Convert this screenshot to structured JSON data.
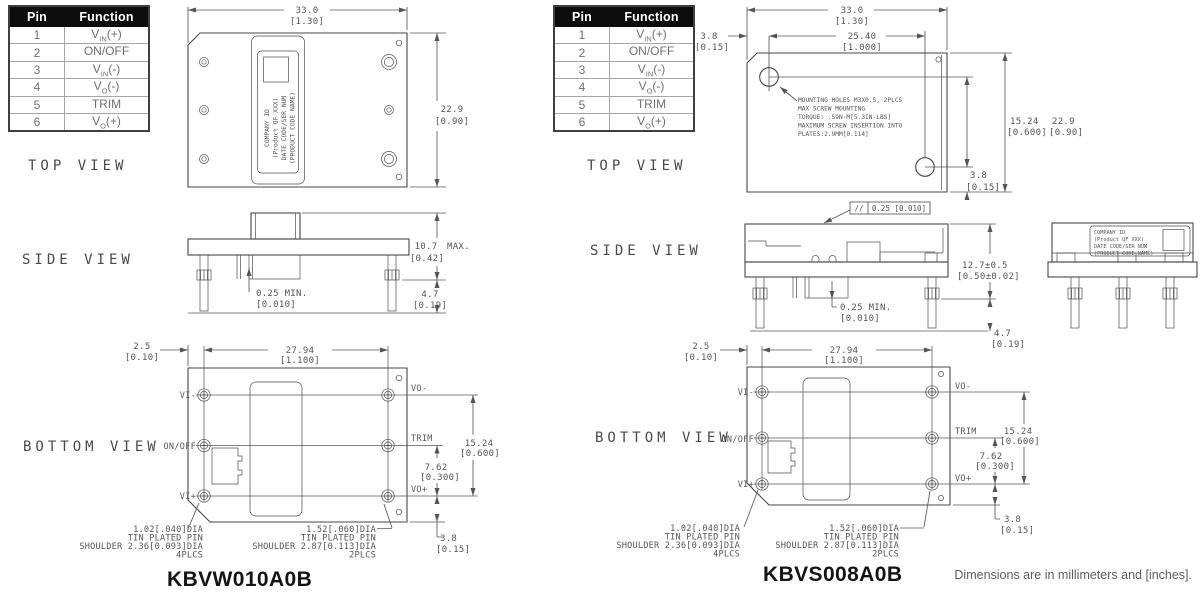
{
  "footer": "Dimensions are in millimeters and [inches].",
  "views": {
    "top": "TOP VIEW",
    "side": "SIDE VIEW",
    "bottom": "BOTTOM VIEW"
  },
  "pin_table": {
    "headers": [
      "Pin",
      "Function"
    ],
    "rows": [
      {
        "pin": "1",
        "pre": "V",
        "sub": "IN",
        "post": "(+)"
      },
      {
        "pin": "2",
        "pre": "ON/OFF",
        "sub": "",
        "post": ""
      },
      {
        "pin": "3",
        "pre": "V",
        "sub": "IN",
        "post": "(-)"
      },
      {
        "pin": "4",
        "pre": "V",
        "sub": "O",
        "post": "(-)"
      },
      {
        "pin": "5",
        "pre": "TRIM",
        "sub": "",
        "post": ""
      },
      {
        "pin": "6",
        "pre": "V",
        "sub": "O",
        "post": "(+)"
      }
    ]
  },
  "module_label": {
    "l1": "COMPANY ID",
    "l2": "(Product QF XXX)",
    "l3": "DATE CODE/SER NUM",
    "l4": "(PRODUCT CODE NAME)"
  },
  "left": {
    "title": "KBVW010A0B",
    "top": {
      "w": "33.0",
      "wb": "[1.30]",
      "h": "22.9",
      "hb": "[0.90]"
    },
    "side": {
      "h": "10.7",
      "max": "MAX.",
      "hb": "[0.42]",
      "min": "0.25 MIN.",
      "minb": "[0.010]",
      "pin": "4.7",
      "pinb": "[0.19]"
    },
    "bottom": {
      "edge": "2.5",
      "edgeb": "[0.10]",
      "pitch": "27.94",
      "pitchb": "[1.100]",
      "v1": "15.24",
      "v1b": "[0.600]",
      "v2": "7.62",
      "v2b": "[0.300]",
      "v3": "3.8",
      "v3b": "[0.15]",
      "vi_m": "VI-",
      "onoff": "ON/OFF",
      "vi_p": "VI+",
      "vo_m": "VO-",
      "trim": "TRIM",
      "vo_p": "VO+"
    },
    "note_a": [
      "1.02[.040]DIA",
      "TIN PLATED PIN",
      "SHOULDER 2.36[0.093]DIA",
      "4PLCS"
    ],
    "note_b": [
      "1.52[.060]DIA",
      "TIN PLATED PIN",
      "SHOULDER 2.87[0.113]DIA",
      "2PLCS"
    ]
  },
  "right": {
    "title": "KBVS008A0B",
    "top": {
      "w": "33.0",
      "wb": "[1.30]",
      "w2": "25.40",
      "w2b": "[1.000]",
      "off": "3.8",
      "offb": "[0.15]",
      "v1": "15.24",
      "v1b": "[0.600]",
      "h": "22.9",
      "hb": "[0.90]",
      "off2": "3.8",
      "off2b": "[0.15]",
      "note": [
        "MOUNTING HOLES M3X0.5, 2PLCS",
        "MAX SCREW MOUNTING",
        "TORQUE: .59N-M[5.3IN-LBS]",
        "MAXIMUM SCREW INSERTION INTO",
        "PLATES:2.9MM[0.114]"
      ]
    },
    "side": {
      "fcf_sym": "//",
      "fcf_val": "0.25 [0.010]",
      "h": "12.7±0.5",
      "hb": "[0.50±0.02]",
      "min": "0.25 MIN.",
      "minb": "[0.010]",
      "pin": "4.7",
      "pinb": "[0.19]"
    },
    "bottom": {
      "edge": "2.5",
      "edgeb": "[0.10]",
      "pitch": "27.94",
      "pitchb": "[1.100]",
      "v1": "15.24",
      "v1b": "[0.600]",
      "v2": "7.62",
      "v2b": "[0.300]",
      "v3": "3.8",
      "v3b": "[0.15]",
      "vi_m": "VI-",
      "onoff": "ON/OFF",
      "vi_p": "VI+",
      "vo_m": "VO-",
      "trim": "TRIM",
      "vo_p": "VO+"
    },
    "note_a": [
      "1.02[.040]DIA",
      "TIN PLATED PIN",
      "SHOULDER 2.36[0.093]DIA",
      "4PLCS"
    ],
    "note_b": [
      "1.52[.060]DIA",
      "TIN PLATED PIN",
      "SHOULDER 2.87[0.113]DIA",
      "2PLCS"
    ]
  }
}
